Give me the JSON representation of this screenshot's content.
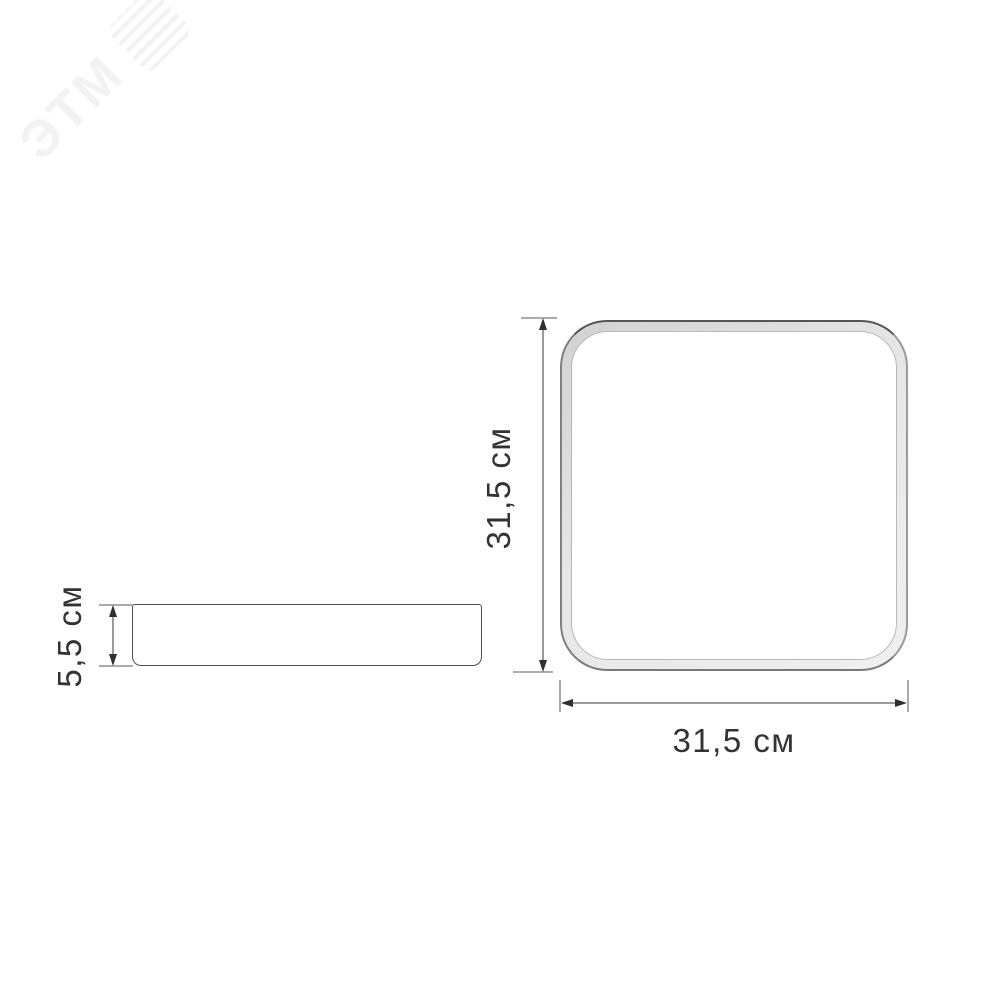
{
  "watermark": {
    "text": "ЭТМ",
    "color": "#f2f2f2"
  },
  "side_view": {
    "height_label": "5,5 см"
  },
  "top_view": {
    "height_label": "31,5 см",
    "width_label": "31,5 см"
  },
  "colors": {
    "background": "#ffffff",
    "outline": "#4f4f4f",
    "dimension_line": "#9a9a9a",
    "extension_line": "#ababab",
    "arrow": "#2f2f2f",
    "label_text": "#333333",
    "frame_fill_dark": "#d2d2d2",
    "frame_fill_light": "#f0f0f0",
    "inner_edge": "#b8b8b8"
  }
}
